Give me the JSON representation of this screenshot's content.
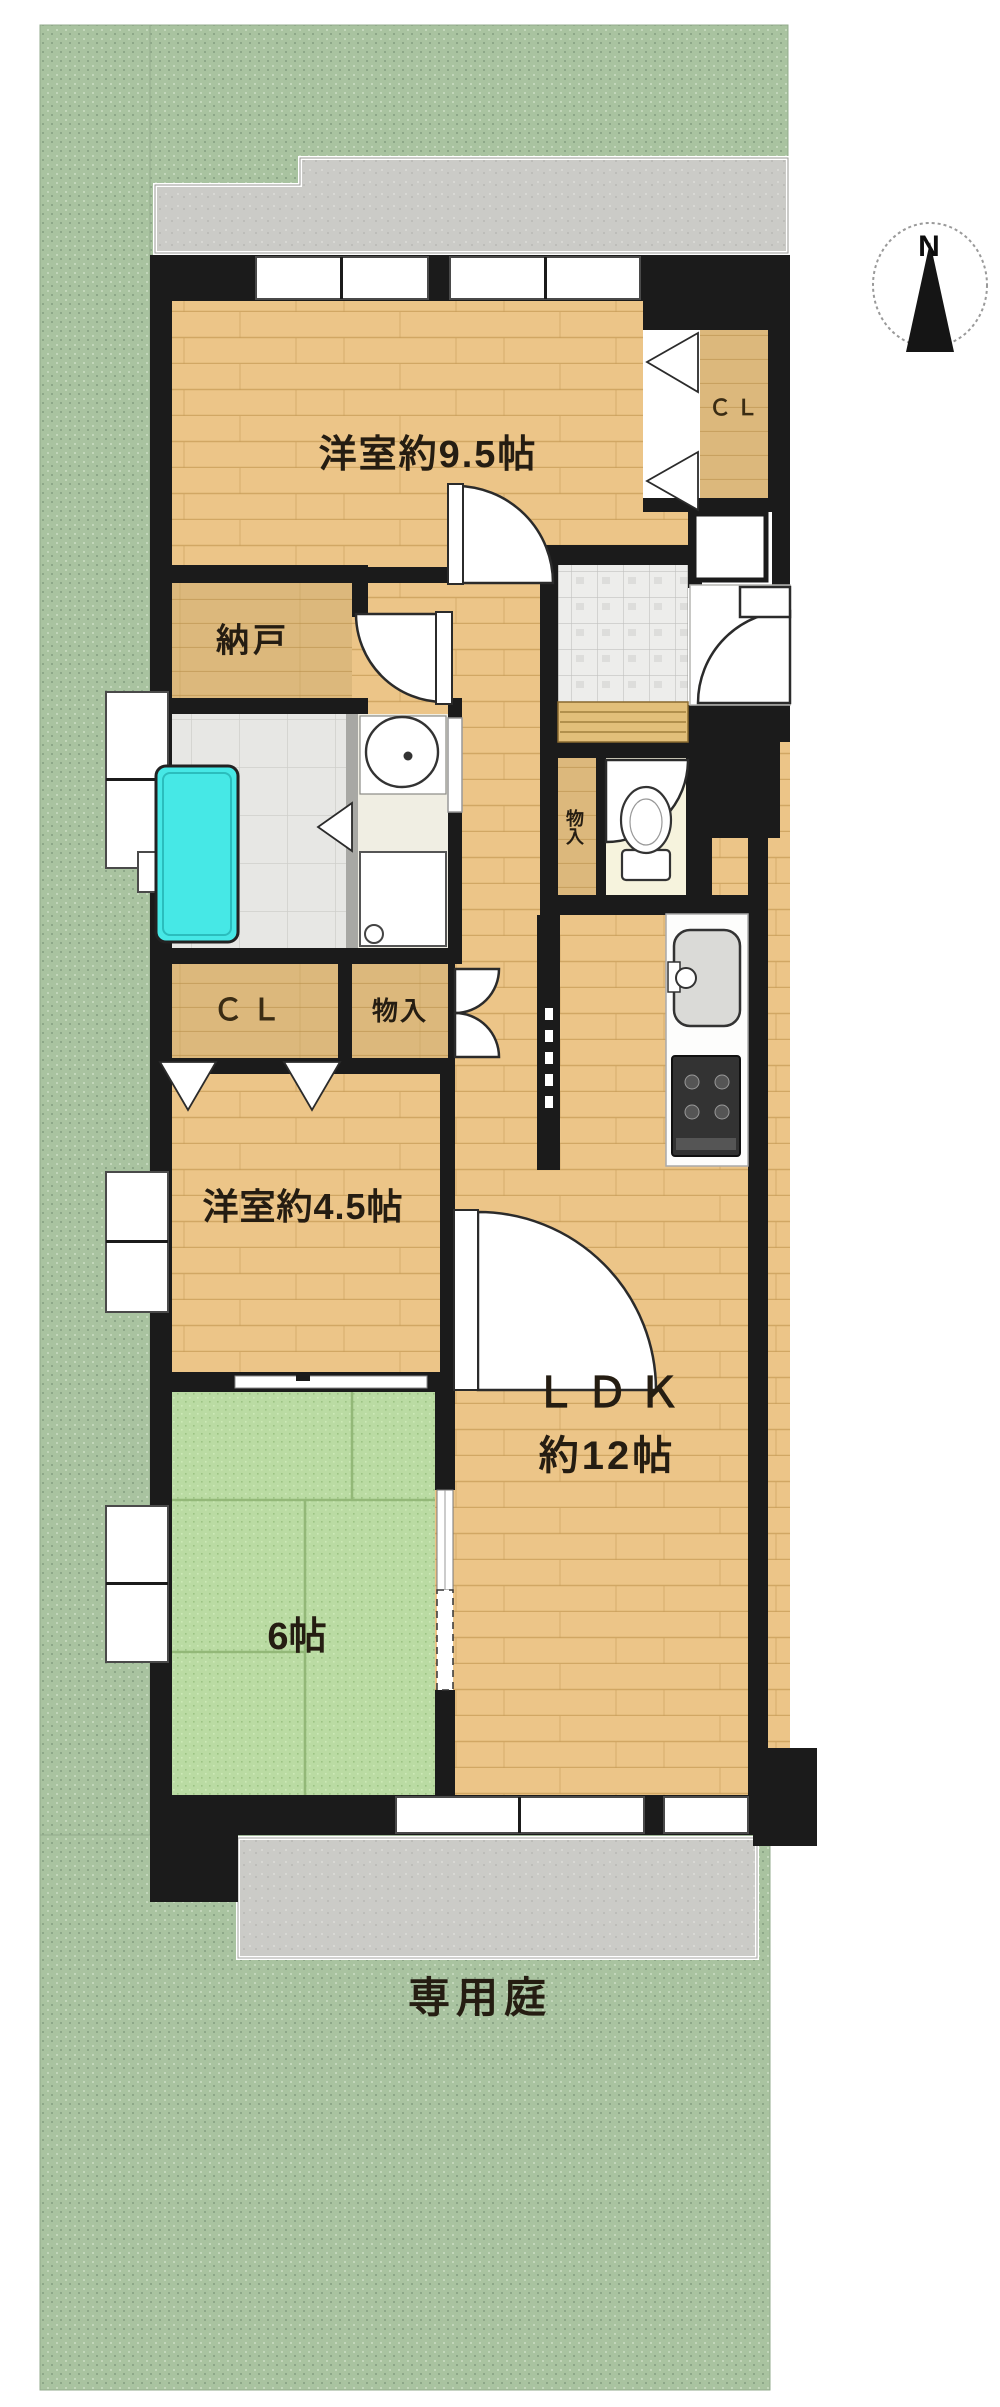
{
  "compass": {
    "north_label": "N"
  },
  "rooms": {
    "western_9_5": {
      "label": "洋室約9.5帖"
    },
    "closet_main": {
      "label": "ＣＬ"
    },
    "nando": {
      "label": "納戸"
    },
    "closet_45": {
      "label": "ＣＬ"
    },
    "monoiri_hall": {
      "label": "物入"
    },
    "monoiri_toilet": {
      "label": "物入"
    },
    "western_45": {
      "label": "洋室約4.5帖"
    },
    "ldk": {
      "label": "ＬＤＫ",
      "size_label": "約12帖"
    },
    "tatami_6": {
      "label": "6帖"
    },
    "private_garden": {
      "label": "専用庭"
    }
  },
  "colors": {
    "garden_green": "#a9c3a0",
    "wood_floor": "#ecc588",
    "closet_wood": "#dcb87c",
    "tatami_green": "#badba3",
    "bathtub_cyan": "#46e8e6",
    "wall_black": "#1b1b1b",
    "pavement_gray": "#cbcbc7",
    "entrance_tile": "#ededeb"
  }
}
